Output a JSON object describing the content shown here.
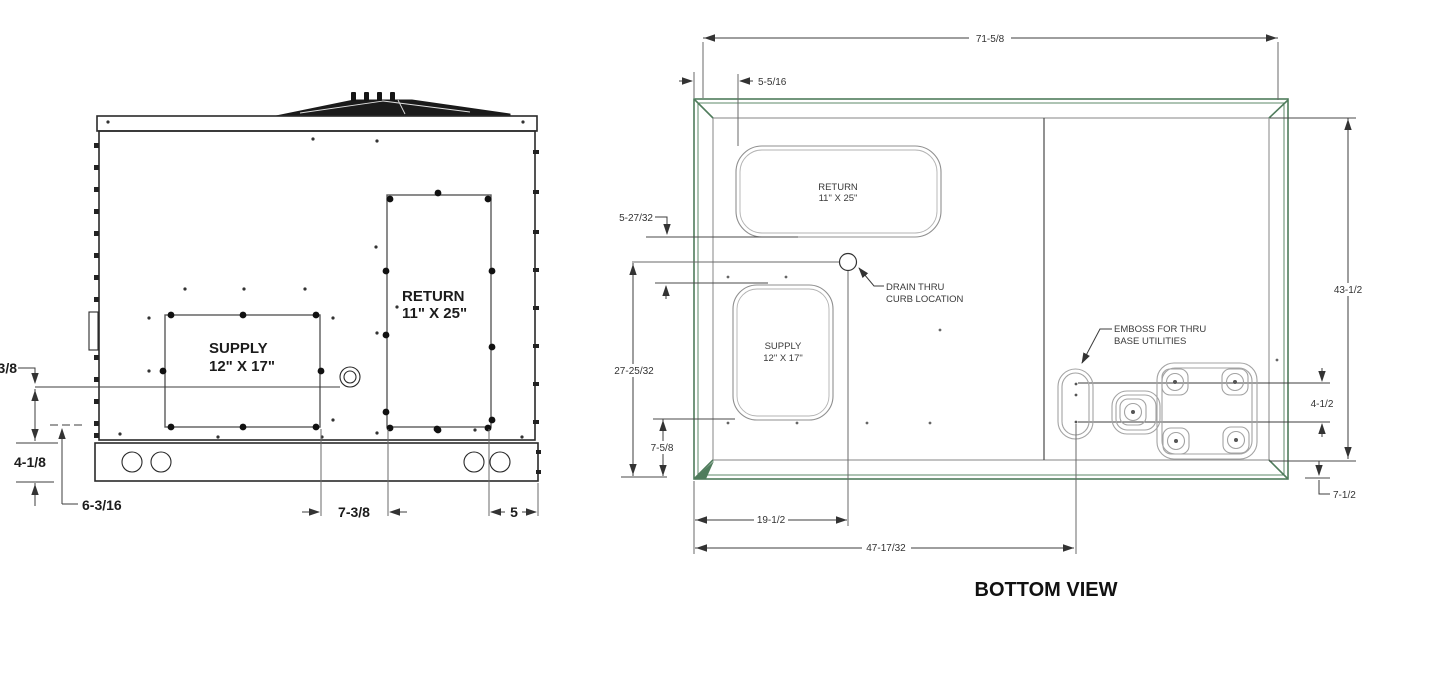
{
  "drawing": {
    "side_view": {
      "supply": {
        "line1": "SUPPLY",
        "line2": "12\" X 17\""
      },
      "return": {
        "line1": "RETURN",
        "line2": "11\" X 25\""
      },
      "dims": {
        "clipped_left": "3/8",
        "base_height": "4-1/8",
        "left_offset": "6-3/16",
        "mid_offset": "7-3/8",
        "right_offset": "5"
      }
    },
    "bottom_view": {
      "title": "BOTTOM VIEW",
      "supply": {
        "line1": "SUPPLY",
        "line2": "12\" X 17\""
      },
      "return": {
        "line1": "RETURN",
        "line2": "11\" X 25\""
      },
      "drain_callout": {
        "line1": "DRAIN THRU",
        "line2": "CURB LOCATION"
      },
      "emboss_callout": {
        "line1": "EMBOSS FOR THRU",
        "line2": "BASE UTILITIES"
      },
      "dims": {
        "overall_width": "71-5/8",
        "return_inset": "5-5/16",
        "return_supply_gap": "5-27/32",
        "drain_from_edge": "27-25/32",
        "supply_from_edge": "7-5/8",
        "overall_depth": "43-1/2",
        "utility_rows": "4-1/2",
        "utility_from_edge": "7-1/2",
        "drain_offset": "19-1/2",
        "emboss_offset": "47-17/32"
      }
    },
    "colors": {
      "frame_green": "#4f7c5c",
      "line_dark": "#2a2a2a",
      "line_gray": "#8f8f8f",
      "dim_line": "#3c3c3c"
    }
  }
}
